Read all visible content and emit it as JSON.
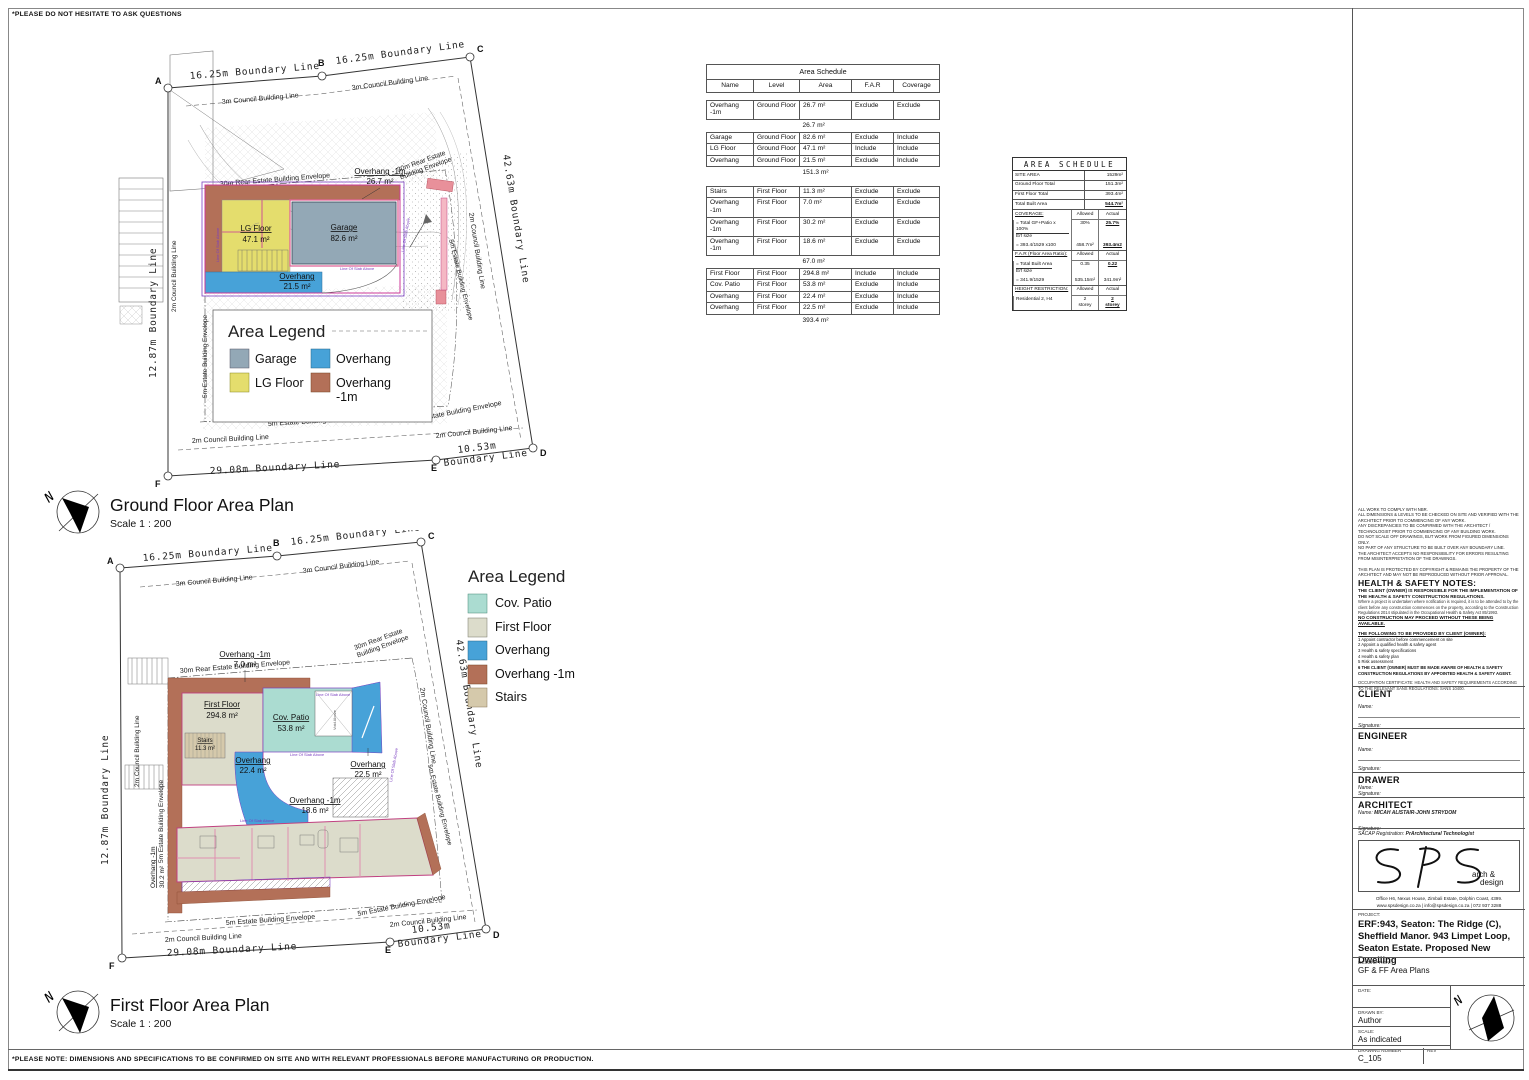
{
  "page": {
    "top_note": "*PLEASE DO NOT HESITATE TO ASK QUESTIONS",
    "bottom_note": "*PLEASE NOTE: DIMENSIONS AND SPECIFICATIONS TO BE CONFIRMED ON SITE AND WITH RELEVANT PROFESSIONALS BEFORE MANUFACTURING OR PRODUCTION."
  },
  "colors": {
    "garage": "#93a8b6",
    "lg_floor": "#e4dd6d",
    "overhang": "#47a2d8",
    "overhang_1m": "#b37058",
    "cov_patio": "#abdcd1",
    "first_floor": "#dcdccb",
    "stairs": "#d5c9ab"
  },
  "ground_plan": {
    "title": "Ground Floor Area Plan",
    "scale": "Scale  1 : 200",
    "north": "N",
    "legend_title": "Area Legend",
    "legend": {
      "garage": "Garage",
      "overhang": "Overhang",
      "lg_floor": "LG Floor",
      "overhang_1m_a": "Overhang",
      "overhang_1m_b": "-1m"
    },
    "pts": {
      "a": "A",
      "b": "B",
      "c": "C",
      "d": "D",
      "e": "E",
      "f": "F"
    },
    "labels": {
      "boundary_ab": "16.25m Boundary Line",
      "boundary_bc": "16.25m Boundary Line",
      "boundary_cd": "42.63m Boundary Line",
      "boundary_de1": "10.53m",
      "boundary_de2": "Boundary Line",
      "boundary_fe": "29.08m Boundary Line",
      "boundary_fa": "12.87m Boundary Line",
      "council_3m": "3m Council Building Line",
      "council_2m": "2m Council Building Line",
      "envelope_30m": "30m Rear Estate Building Envelope",
      "envelope_30m_a": "30m Rear Estate",
      "envelope_30m_b": "Building Envelope",
      "envelope_5m": "5m Estate Building Envelope",
      "slab": "Line Of Slab Above"
    },
    "areas": {
      "overhang_1m_name": "Overhang -1m",
      "overhang_1m_val": "26.7 m²",
      "lg_name": "LG Floor",
      "lg_val": "47.1 m²",
      "garage_name": "Garage",
      "garage_val": "82.6 m²",
      "overhang_name": "Overhang",
      "overhang_val": "21.5 m²"
    }
  },
  "first_plan": {
    "title": "First Floor Area Plan",
    "scale": "Scale  1 : 200",
    "north": "N",
    "legend_title": "Area Legend",
    "legend": {
      "cov_patio": "Cov. Patio",
      "first_floor": "First Floor",
      "overhang": "Overhang",
      "overhang_1m": "Overhang -1m",
      "stairs": "Stairs"
    },
    "pts": {
      "a": "A",
      "b": "B",
      "c": "C",
      "d": "D",
      "e": "E",
      "f": "F"
    },
    "labels": {
      "boundary_ab": "16.25m Boundary Line",
      "boundary_bc": "16.25m Boundary Line",
      "boundary_cd": "42.63m Boundary Line",
      "boundary_de1": "10.53m",
      "boundary_de2": "Boundary Line",
      "boundary_fe": "29.08m Boundary Line",
      "boundary_fa": "12.87m Boundary Line",
      "council_3m": "3m Council Building Line",
      "council_2m": "2m Council Building Line",
      "envelope_30m": "30m Rear Estate Building Envelope",
      "envelope_30m_a": "30m Rear Estate",
      "envelope_30m_b": "Building Envelope",
      "envelope_5m": "5m Estate Building Envelope",
      "slab": "Line Of Slab Above",
      "void_above": "Void Above"
    },
    "areas": {
      "oh1m_7_name": "Overhang -1m",
      "oh1m_7_val": "7.0 m²",
      "ff_name": "First Floor",
      "ff_val": "294.8 m²",
      "patio_name": "Cov. Patio",
      "patio_val": "53.8 m²",
      "stairs_name": "Stairs",
      "stairs_val": "11.3 m²",
      "oh_a_name": "Overhang",
      "oh_a_val": "22.4 m²",
      "oh_b_name": "Overhang",
      "oh_b_val": "22.5 m²",
      "oh1m_18_name": "Overhang -1m",
      "oh1m_18_val": "18.6 m²",
      "oh1m_30_name": "Overhang -1m",
      "oh1m_30_val": "30.2 m²"
    }
  },
  "schedule": {
    "title": "Area Schedule",
    "headers": [
      "Name",
      "Level",
      "Area",
      "F.A.R",
      "Coverage"
    ],
    "rows": [
      {
        "name": "Overhang -1m",
        "level": "Ground Floor",
        "area": "26.7 m²",
        "far": "Exclude",
        "coverage": "Exclude"
      },
      {
        "name": "Garage",
        "level": "Ground Floor",
        "area": "82.6 m²",
        "far": "Exclude",
        "coverage": "Include"
      },
      {
        "name": "LG Floor",
        "level": "Ground Floor",
        "area": "47.1 m²",
        "far": "Include",
        "coverage": "Include"
      },
      {
        "name": "Overhang",
        "level": "Ground Floor",
        "area": "21.5 m²",
        "far": "Exclude",
        "coverage": "Include"
      },
      {
        "name": "Stairs",
        "level": "First Floor",
        "area": "11.3 m²",
        "far": "Exclude",
        "coverage": "Exclude"
      },
      {
        "name": "Overhang -1m",
        "level": "First Floor",
        "area": "7.0 m²",
        "far": "Exclude",
        "coverage": "Exclude"
      },
      {
        "name": "Overhang -1m",
        "level": "First Floor",
        "area": "30.2 m²",
        "far": "Exclude",
        "coverage": "Exclude"
      },
      {
        "name": "Overhang -1m",
        "level": "First Floor",
        "area": "18.6 m²",
        "far": "Exclude",
        "coverage": "Exclude"
      },
      {
        "name": "First Floor",
        "level": "First Floor",
        "area": "294.8 m²",
        "far": "Include",
        "coverage": "Include"
      },
      {
        "name": "Cov. Patio",
        "level": "First Floor",
        "area": "53.8 m²",
        "far": "Exclude",
        "coverage": "Include"
      },
      {
        "name": "Overhang",
        "level": "First Floor",
        "area": "22.4 m²",
        "far": "Exclude",
        "coverage": "Include"
      },
      {
        "name": "Overhang",
        "level": "First Floor",
        "area": "22.5 m²",
        "far": "Exclude",
        "coverage": "Include"
      }
    ],
    "subtotals": [
      "26.7 m²",
      "151.3 m²",
      "67.0 m²",
      "393.4 m²"
    ]
  },
  "summary": {
    "title": "AREA SCHEDULE",
    "site_area_label": "SITE AREA",
    "site_area": "1529m²",
    "gf_label": "Ground Floor Total",
    "gf": "151.3m²",
    "ff_label": "First Floor Total",
    "ff": "393.4m²",
    "total_label": "Total Built Area",
    "total": "544.7m²",
    "allowed": "Allowed",
    "actual": "Actual",
    "coverage_label": "COVERAGE:",
    "coverage_f1": "= Total GF+Patio x 100%",
    "coverage_f2": "Erf size",
    "coverage_f3": "= 393.4/1529 x100",
    "coverage_allowed1": "30%",
    "coverage_actual1": "25.7%",
    "coverage_allowed2": "458.7m²",
    "coverage_actual2": "393.4m2",
    "far_label": "F.A.R (Floor Area Ratio):",
    "far_f1": "= Total Built Area",
    "far_f2": "Erf size",
    "far_f3": "= 341.9/1529",
    "far_allowed1": "0.35",
    "far_actual1": "0.22",
    "far_allowed2": "535.15m²",
    "far_actual2": "341.9m²",
    "height_label": "HEIGHT RESTRICTION:",
    "height_desc": "Residential 2, H4",
    "height_allowed1": "2",
    "height_allowed2": "storey",
    "height_actual1": "2",
    "height_actual2": "storey"
  },
  "titleblock": {
    "general_notes": [
      "ALL WORK TO COMPLY WITH NBR.",
      "ALL DIMENSIONS & LEVELS TO BE CHECKED ON SITE AND VERIFIED WITH THE ARCHITECT PRIOR TO COMMENCING OF ANY WORK.",
      "ANY DISCREPANCIES TO BE CONFIRMED WITH THE ARCHITECT / TECHNOLOGIST PRIOR TO COMMENCING OF ANY BUILDING WORK.",
      "DO NOT SCALE OFF DRAWINGS, BUT WORK FROM FIGURED DIMENSIONS ONLY.",
      "NO PART OF ANY STRUCTURE TO BE BUILT OVER ANY BOUNDARY LINE.",
      "THE ARCHITECT ACCEPTS NO RESPONSIBILITY FOR ERRORS RESULTING FROM MISINTERPRETATION OF THE DRAWINGS."
    ],
    "copyright_note": "THIS PLAN IS PROTECTED BY COPYRIGHT & REMAINS THE PROPERTY OF THE ARCHITECT AND MAY NOT BE REPRODUCED WITHOUT PRIOR APPROVAL.",
    "hs_title": "HEALTH & SAFETY NOTES:",
    "hs_bold1": "THE CLIENT (OWNER) IS RESPONSIBLE FOR THE IMPLEMENTATION OF THE HEALTH & SAFETY CONSTRUCTION REGULATIONS.",
    "hs_para": "Where a project is undertaken where notification is required, it is to be attended to by the client before any construction commences on the property, according to the Construction Regulations 2014 stipulated in the Occupational Health & Safety Act 85/1993.",
    "hs_bold2": "NO CONSTRUCTION MAY PROCEED WITHOUT THESE BEING AVAILABLE.",
    "hs_provide_title": "THE FOLLOWING TO BE PROVIDED BY CLIENT (OWNER):",
    "hs_list": [
      "1  Appoint contractor before commencement on site",
      "2  Appoint a qualified health & safety agent",
      "3  Health & safety specifications",
      "4  Health & safety plan",
      "5  Risk assessment",
      "6  THE CLIENT (OWNER) MUST BE MADE AWARE OF HEALTH & SAFETY CONSTRUCTION REGULATIONS BY APPOINTED HEALTH & SAFETY AGENT."
    ],
    "hs_closing": "OCCUPATION CERTIFICATE: HEALTH AND SAFETY REQUIREMENTS ACCORDING TO THE RELEVANT SANS REGULATIONS: SANS 10400.",
    "client_title": "CLIENT",
    "engineer_title": "ENGINEER",
    "drawer_title": "DRAWER",
    "architect_title": "ARCHITECT",
    "name_label": "Name:",
    "signature_label": "Signature:",
    "architect_name": "MICAH ALISTAIR-JOHN STRYDOM",
    "sacap_label": "SACAP Registration:",
    "sacap_value": "PrArchitectural Technologist",
    "logo_sub1": "arch &",
    "logo_sub2": "design",
    "address1": "Office H6, Nexus House, Zimbali Estate, Dolphin Coast, 4399.",
    "address2": "www.spsdesign.co.za | info@spsdesign.co.za | 072 937 3288",
    "project_label": "PROJECT:",
    "project_text": "ERF:943, Seaton: The Ridge (C), Sheffield Manor. 943 Limpet Loop, Seaton Estate. Proposed New Dwelling",
    "description_label": "DESCRIPTION:",
    "description_text": "GF & FF Area Plans",
    "date_label": "DATE:",
    "drawn_by_label": "DRAWN BY:",
    "drawn_by": "Author",
    "scale_label": "SCALE:",
    "scale_value": "As indicated",
    "drawing_number_label": "DRAWING NUMBER",
    "drawing_number": "C_105",
    "rev_label": "REV",
    "north": "N"
  }
}
